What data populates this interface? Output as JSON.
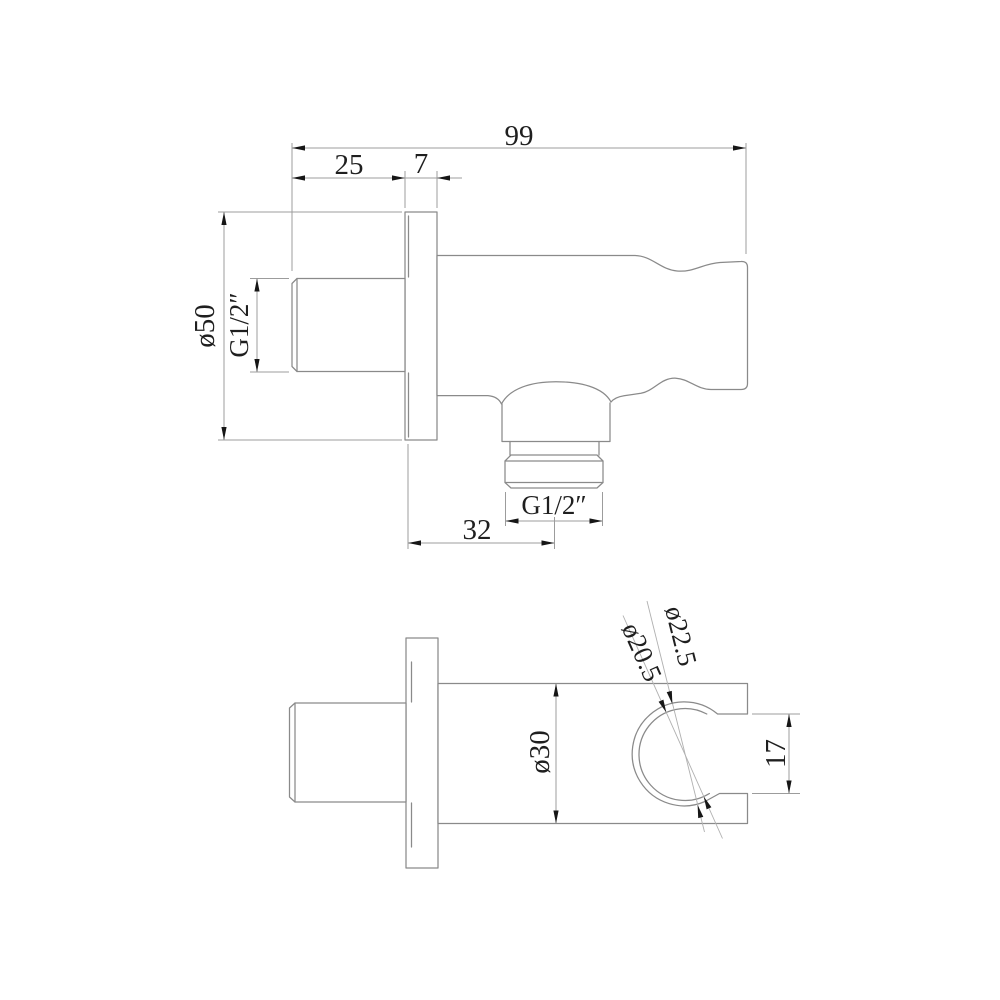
{
  "drawing": {
    "type": "technical-drawing",
    "subject": "wall-mounted shower outlet elbow with hand shower holder, two orthographic views",
    "colors": {
      "line": "#8a8a8a",
      "dim": "#9c9c9c",
      "leader": "#b0b0b0",
      "text": "#1f1f1f",
      "arrow": "#161616",
      "bg": "#ffffff"
    },
    "side_view": {
      "name": "side elevation view",
      "labels": {
        "overall_length": "99",
        "inlet_length": "25",
        "flange_thickness": "7",
        "flange_diameter": "ø50",
        "inlet_thread": "G1/2″",
        "outlet_thread": "G1/2″",
        "outlet_offset": "32"
      }
    },
    "top_view": {
      "name": "top plan view",
      "labels": {
        "body_diameter": "ø30",
        "holder_opening": "17",
        "holder_inner_diameter": "ø20.5",
        "holder_outer_diameter": "ø22.5"
      }
    }
  }
}
